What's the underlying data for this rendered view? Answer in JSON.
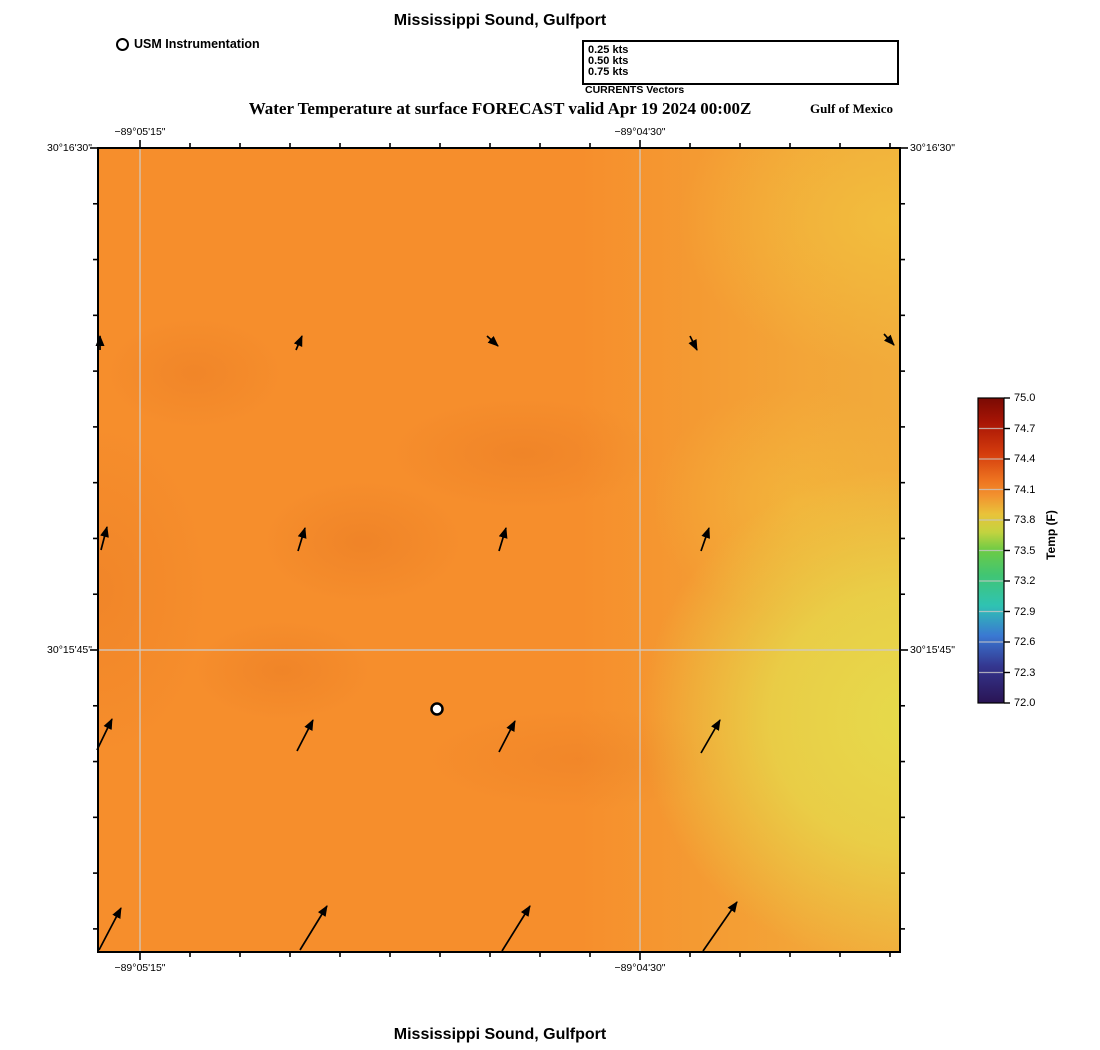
{
  "header": {
    "title": "Mississippi Sound, Gulfport",
    "instrument_legend": {
      "label": "USM Instrumentation"
    },
    "vector_legend": {
      "caption": "CURRENTS Vectors",
      "items": [
        {
          "label": "0.25 kts",
          "len_px": 78
        },
        {
          "label": "0.50 kts",
          "len_px": 158
        },
        {
          "label": "0.75 kts",
          "len_px": 238
        }
      ]
    },
    "subtitle": "Water Temperature at surface FORECAST valid Apr 19 2024 00:00Z",
    "region_label": "Gulf of Mexico"
  },
  "footer": {
    "title": "Mississippi Sound, Gulfport"
  },
  "map": {
    "colors": {
      "base": "#f68e2c",
      "yellow": "#e6da4b",
      "warm_yellow": "#f2c23e",
      "mid_yellow": "#eec84a",
      "dark_orange": "#ea7b24",
      "gridline": "#cfcac4",
      "border": "#000000"
    },
    "station_marker": {
      "x": 437,
      "y": 709,
      "label": "USM Instrumentation"
    }
  },
  "axes": {
    "top": [
      {
        "label": "−89°05'15\"",
        "x": 140
      },
      {
        "label": "−89°04'30\"",
        "x": 640
      }
    ],
    "bottom": [
      {
        "label": "−89°05'15\"",
        "x": 140
      },
      {
        "label": "−89°04'30\"",
        "x": 640
      }
    ],
    "left": [
      {
        "label": "30°16'30\"",
        "y": 148
      },
      {
        "label": "30°15'45\"",
        "y": 650
      }
    ],
    "right": [
      {
        "label": "30°16'30\"",
        "y": 148
      },
      {
        "label": "30°15'45\"",
        "y": 650
      }
    ]
  },
  "colorbar": {
    "title": "Temp (F)",
    "ticks": [
      "75.0",
      "74.7",
      "74.4",
      "74.1",
      "73.8",
      "73.5",
      "73.2",
      "72.9",
      "72.6",
      "72.3",
      "72.0"
    ],
    "stops": [
      {
        "offset": 0.0,
        "color": "#7a0a04"
      },
      {
        "offset": 0.08,
        "color": "#a81505"
      },
      {
        "offset": 0.18,
        "color": "#d33b0d"
      },
      {
        "offset": 0.27,
        "color": "#ee7420"
      },
      {
        "offset": 0.32,
        "color": "#f2922f"
      },
      {
        "offset": 0.38,
        "color": "#e9c23a"
      },
      {
        "offset": 0.44,
        "color": "#c3d33f"
      },
      {
        "offset": 0.5,
        "color": "#6ccb45"
      },
      {
        "offset": 0.58,
        "color": "#41c573"
      },
      {
        "offset": 0.68,
        "color": "#2fc3b2"
      },
      {
        "offset": 0.78,
        "color": "#3a78d2"
      },
      {
        "offset": 0.88,
        "color": "#34368f"
      },
      {
        "offset": 1.0,
        "color": "#2a1454"
      }
    ]
  },
  "chart_data": {
    "type": "heatmap",
    "title": "Water Temperature at surface FORECAST valid Apr 19 2024 00:00Z",
    "site": "Mississippi Sound, Gulfport",
    "variable": "Water Temperature at surface",
    "valid_time": "Apr 19 2024 00:00Z",
    "units": "F",
    "region_label": "Gulf of Mexico",
    "colorbar_range": [
      72.0,
      75.0
    ],
    "colorbar_tick_step": 0.3,
    "lon_ticks": [
      "−89°05'15\"",
      "−89°04'30\""
    ],
    "lat_ticks": [
      "30°16'30\"",
      "30°15'45\""
    ],
    "field_summary": {
      "west": 74.3,
      "center": 74.2,
      "north": 74.3,
      "east_edge_min": 73.8,
      "southeast": 74.1,
      "description": "mostly orange ~74.1-74.4 F, cooler yellow band ~73.8 F along east edge"
    },
    "station": {
      "name": "USM Instrumentation",
      "px": {
        "x": 437,
        "y": 709
      }
    },
    "legend_scale_kts": [
      0.25,
      0.5,
      0.75
    ],
    "current_vectors": [
      {
        "x1": 100,
        "y1": 350,
        "x2": 100,
        "y2": 336,
        "dir": "N",
        "speed_kts_est": 0.04
      },
      {
        "x1": 296,
        "y1": 350,
        "x2": 302,
        "y2": 336,
        "dir": "NNE",
        "speed_kts_est": 0.05
      },
      {
        "x1": 487,
        "y1": 336,
        "x2": 498,
        "y2": 346,
        "dir": "SE",
        "speed_kts_est": 0.04
      },
      {
        "x1": 690,
        "y1": 336,
        "x2": 697,
        "y2": 350,
        "dir": "SSE",
        "speed_kts_est": 0.05
      },
      {
        "x1": 884,
        "y1": 334,
        "x2": 894,
        "y2": 345,
        "dir": "SE",
        "speed_kts_est": 0.04
      },
      {
        "x1": 101,
        "y1": 550,
        "x2": 107,
        "y2": 527,
        "dir": "NNE",
        "speed_kts_est": 0.08
      },
      {
        "x1": 298,
        "y1": 551,
        "x2": 305,
        "y2": 528,
        "dir": "NNE",
        "speed_kts_est": 0.08
      },
      {
        "x1": 499,
        "y1": 551,
        "x2": 506,
        "y2": 528,
        "dir": "NNE",
        "speed_kts_est": 0.08
      },
      {
        "x1": 701,
        "y1": 551,
        "x2": 709,
        "y2": 528,
        "dir": "NNE",
        "speed_kts_est": 0.08
      },
      {
        "x1": 97,
        "y1": 750,
        "x2": 112,
        "y2": 719,
        "dir": "NNE",
        "speed_kts_est": 0.12
      },
      {
        "x1": 297,
        "y1": 751,
        "x2": 313,
        "y2": 720,
        "dir": "NNE",
        "speed_kts_est": 0.12
      },
      {
        "x1": 499,
        "y1": 752,
        "x2": 515,
        "y2": 721,
        "dir": "NNE",
        "speed_kts_est": 0.12
      },
      {
        "x1": 701,
        "y1": 753,
        "x2": 720,
        "y2": 720,
        "dir": "NNE",
        "speed_kts_est": 0.13
      },
      {
        "x1": 99,
        "y1": 950,
        "x2": 121,
        "y2": 908,
        "dir": "NE",
        "speed_kts_est": 0.17
      },
      {
        "x1": 300,
        "y1": 950,
        "x2": 327,
        "y2": 906,
        "dir": "NE",
        "speed_kts_est": 0.18
      },
      {
        "x1": 502,
        "y1": 951,
        "x2": 530,
        "y2": 906,
        "dir": "NE",
        "speed_kts_est": 0.18
      },
      {
        "x1": 703,
        "y1": 951,
        "x2": 737,
        "y2": 902,
        "dir": "NE",
        "speed_kts_est": 0.2
      }
    ]
  }
}
